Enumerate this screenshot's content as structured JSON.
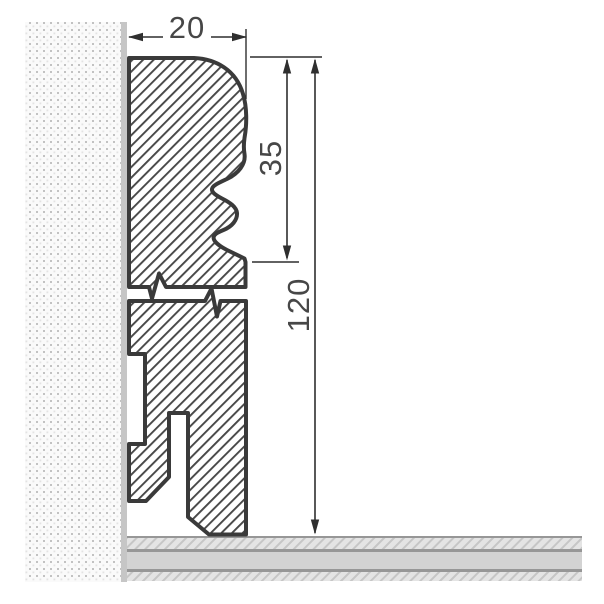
{
  "colors": {
    "outline": "#3a3a3a",
    "hatch-line": "#474747",
    "dim": "#2f2f2f",
    "text": "#474747",
    "membrane": "#c6c6c6",
    "wall-bg": "#fafafa",
    "wall-dot-a": "#c2c2c2",
    "wall-dot-b": "#e3e3e3",
    "floor-hatch-bg": "#e4e4e4",
    "floor-hatch-line": "#c6c6c6",
    "floor-mid": "#d3d3d3",
    "floor-line": "#979797",
    "profile-fill": "#ffffff"
  },
  "dimensions": {
    "width_label": "20",
    "upper_height_label": "35",
    "total_height_label": "120"
  }
}
